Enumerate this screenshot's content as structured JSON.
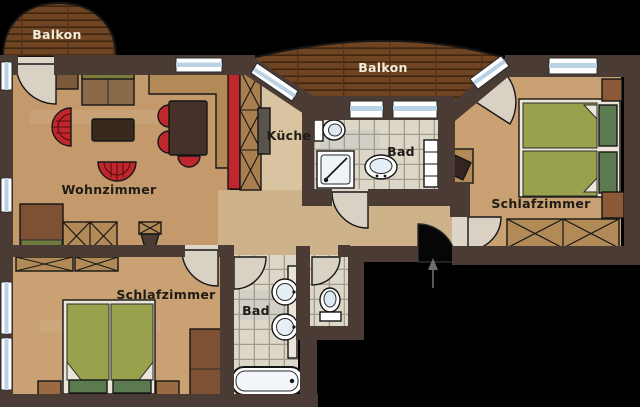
{
  "title": "apartment-floorplan",
  "labels": {
    "balcony_left": "Balkon",
    "balcony_top": "Balkon",
    "kitchen": "Küche",
    "bath_top": "Bad",
    "living_room": "Wohnzimmer",
    "bedroom_right": "Schlafzimmer",
    "bedroom_left": "Schlafzimmer",
    "bath_bottom": "Bad"
  },
  "colors": {
    "background": "#000000",
    "wall": "#4a3b34",
    "floor_living": "#c49a6c",
    "floor_kitchen": "#d9c4a1",
    "floor_hall": "#cdb28a",
    "floor_bedroom": "#c9a172",
    "wood_deck": "#6e4423",
    "tile": "#dcd7c9",
    "accent_red": "#c0272d",
    "bed_green": "#99a14d",
    "blanket_green": "#5c7a50",
    "fixture_white": "#ffffff",
    "window_blue": "#b9d2e4",
    "door_swing": "#d8d1c4",
    "furniture_wood": "#b28a58",
    "furniture_dark": "#38291f"
  }
}
